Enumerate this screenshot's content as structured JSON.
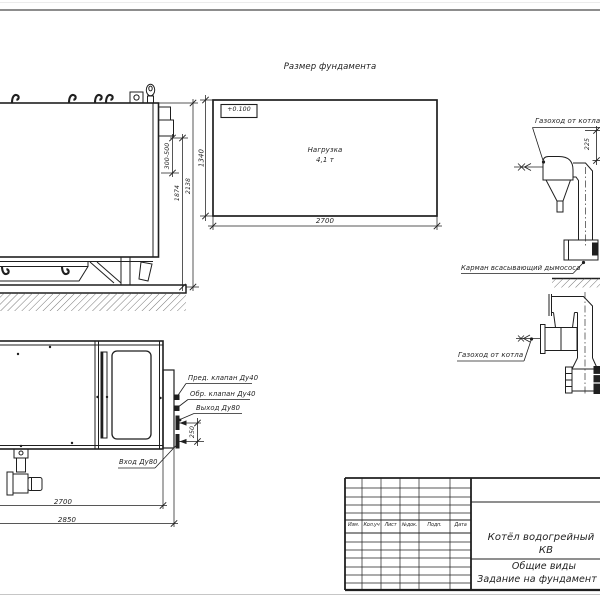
{
  "colors": {
    "ink": "#1f1f1f",
    "top_edge": "#8d8d8d",
    "bottom_edge": "#c6c6c6"
  },
  "foundation_plan": {
    "title": "Размер фундамента",
    "elevation": "+0.100",
    "load_label": "Нагрузка",
    "load_value": "4,1 т",
    "dim_width": "2700",
    "dim_depth": "1340"
  },
  "side_view": {
    "dim_stub": "300-500",
    "dim_height_inner": "1874",
    "dim_height_total": "2138"
  },
  "flue_top": {
    "label": "Газоход от котла",
    "dim": "225",
    "pocket_label": "Карман всасывающий дымососа"
  },
  "flue_bottom": {
    "label": "Газоход от котла"
  },
  "top_view": {
    "label_safety_valve": "Пред. клапан Ду40",
    "label_check_valve": "Обр. клапан Ду40",
    "label_outlet": "Выход Ду80",
    "label_inlet": "Вход Ду80",
    "dim_spacing": "250",
    "dim_length": "2700",
    "dim_overall": "2850"
  },
  "title_block": {
    "columns": [
      "Изм.",
      "Кол.уч",
      "Лист",
      "№док.",
      "Подп.",
      "Дата"
    ],
    "product_line1": "Котёл водогрейный",
    "product_line2": "КВ",
    "doc_type": "Общие виды",
    "doc_subtitle": "Задание на фундамент"
  }
}
